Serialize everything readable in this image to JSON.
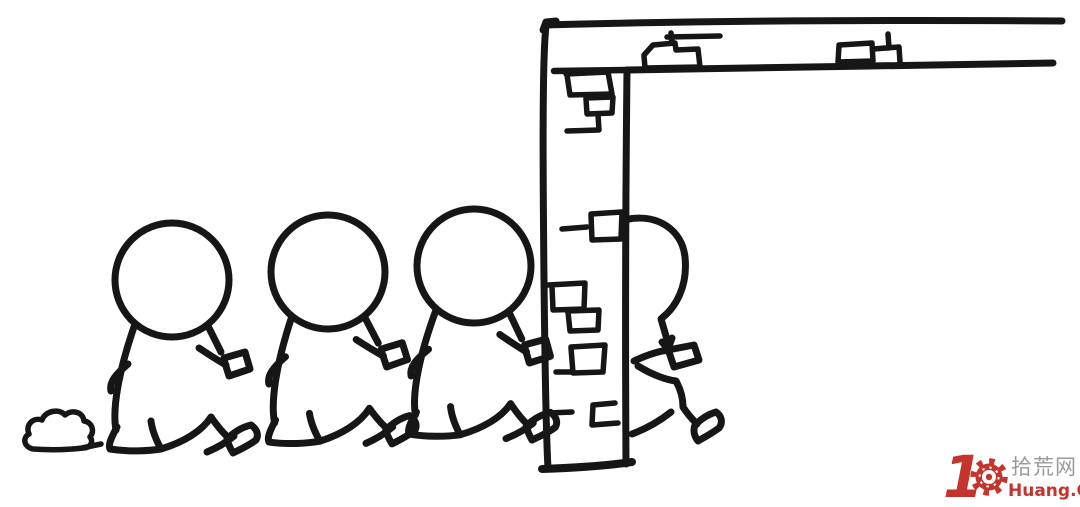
{
  "scene": {
    "type": "hand-drawn line-art cartoon",
    "background_color": "#ffffff",
    "ink_color": "#161616",
    "objects": [
      "three round-headed figures walking right in a queue, each hand on the back of the one ahead",
      "tall brick wall with ceiling beam extending right",
      "lead figure passing through the wall, front half emerging on the other side",
      "small dust puff behind the last figure"
    ]
  },
  "watermark": {
    "big_number": "1",
    "zero_icon": "gear",
    "site_cn": "拾荒网",
    "site_en": "Huang.CN",
    "red": "#c5332d",
    "gray": "#9a9a9a"
  }
}
